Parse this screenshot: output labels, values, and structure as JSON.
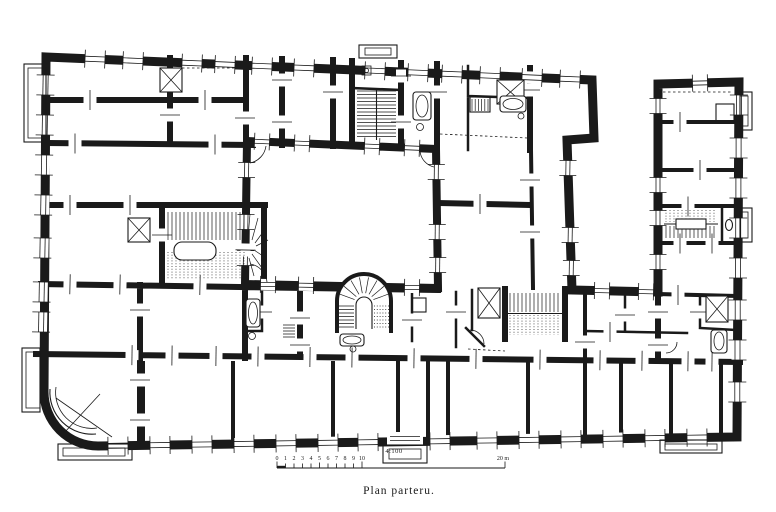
{
  "figure": {
    "caption": "Plan parteru.",
    "scale_label": "4:100",
    "scale_bar": {
      "tick_labels": [
        "0",
        "1",
        "2",
        "3",
        "4",
        "5",
        "6",
        "7",
        "8",
        "9",
        "10"
      ],
      "end_label": "20 m"
    },
    "colors": {
      "ink": "#1a1a1a",
      "paper": "#ffffff"
    }
  },
  "plan": {
    "features": [
      "west-staircase",
      "north-staircase",
      "south-courtyard-staircase",
      "east-courtyard-staircase",
      "east-wing-staircase",
      "west-courtyard",
      "east-courtyard",
      "light-shafts",
      "bathrooms",
      "bay-windows",
      "rounded-southwest-corner",
      "entrance-porch"
    ]
  }
}
